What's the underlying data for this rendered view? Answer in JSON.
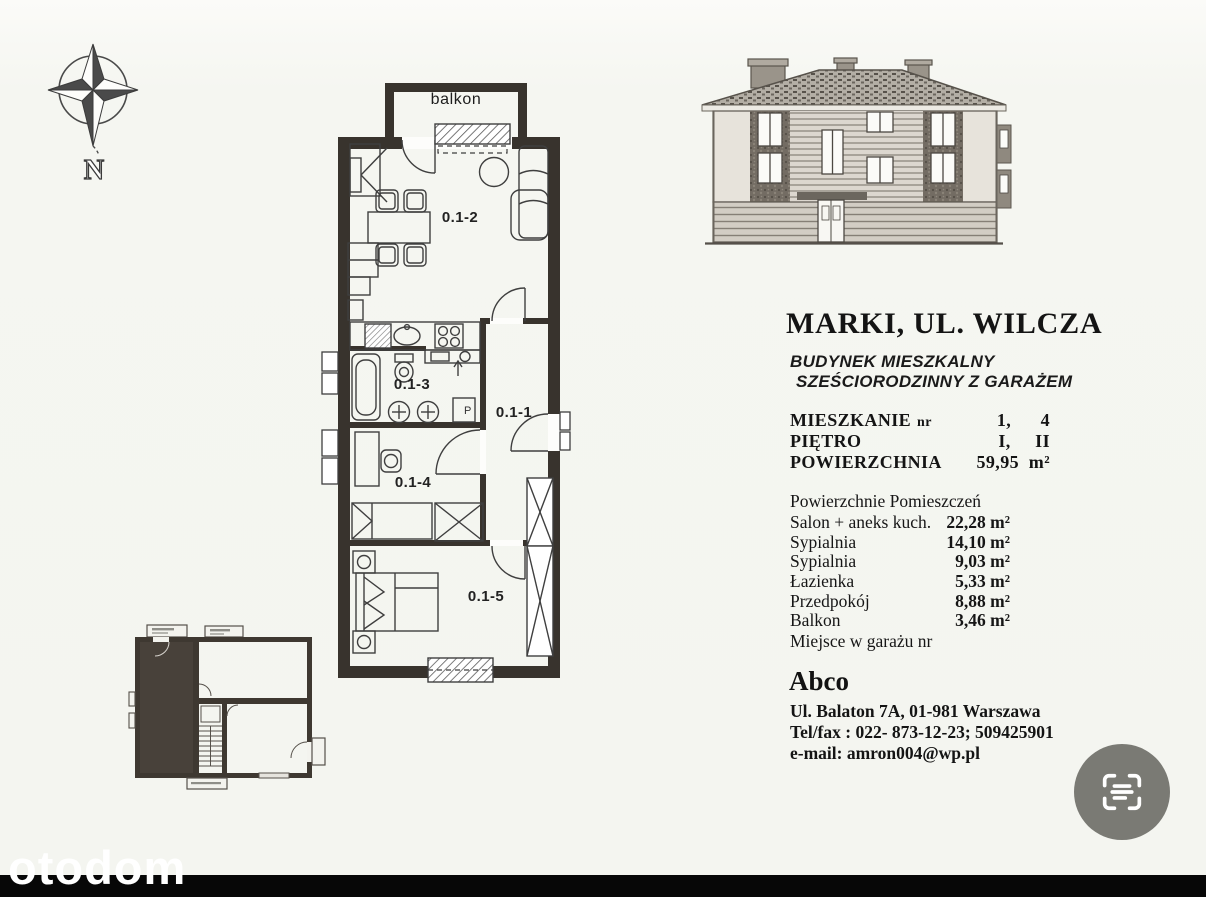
{
  "compass": {
    "label": "N"
  },
  "plan": {
    "balcony_label": "balkon",
    "room_labels": [
      "0.1-1",
      "0.1-2",
      "0.1-3",
      "0.1-4",
      "0.1-5"
    ],
    "washer_label": "P"
  },
  "building": {
    "title": "MARKI, UL. WILCZA",
    "subtitle_line1": "BUDYNEK MIESZKALNY",
    "subtitle_line2": "SZEŚCIORODZINNY Z GARAŻEM"
  },
  "details": {
    "rows": [
      {
        "label": "MIESZKANIE",
        "suffix": "nr",
        "value": "1,      4"
      },
      {
        "label": "PIĘTRO",
        "suffix": "",
        "value": "I,     II"
      },
      {
        "label": "POWIERZCHNIA",
        "suffix": "",
        "value": "59,95  m²"
      }
    ]
  },
  "areas": {
    "heading": "Powierzchnie Pomieszczeń",
    "rows": [
      {
        "name": "Salon + aneks kuch.",
        "value": "22,28 m²"
      },
      {
        "name": "Sypialnia",
        "value": "14,10 m²"
      },
      {
        "name": "Sypialnia",
        "value": "9,03 m²"
      },
      {
        "name": "Łazienka",
        "value": "5,33 m²"
      },
      {
        "name": "Przedpokój",
        "value": "8,88 m²"
      },
      {
        "name": "Balkon",
        "value": "3,46 m²"
      }
    ],
    "footer": "Miejsce w garażu nr"
  },
  "agency": {
    "name": "Abco",
    "address": "Ul. Balaton 7A, 01-981 Warszawa",
    "phone": "Tel/fax : 022- 873-12-23; 509425901",
    "email": "e-mail: amron004@wp.pl"
  },
  "watermark": "otodom",
  "icons": {
    "scan_button": "scan-text-icon",
    "compass": "compass-rose-icon"
  },
  "colors": {
    "page_bg": "#f5f6f1",
    "ink": "#1c1c1c",
    "wall": "#38332d",
    "keyplan_highlight": "#48413a",
    "scan_button_bg": "#7a7a74",
    "bottom_bar": "#070707"
  }
}
